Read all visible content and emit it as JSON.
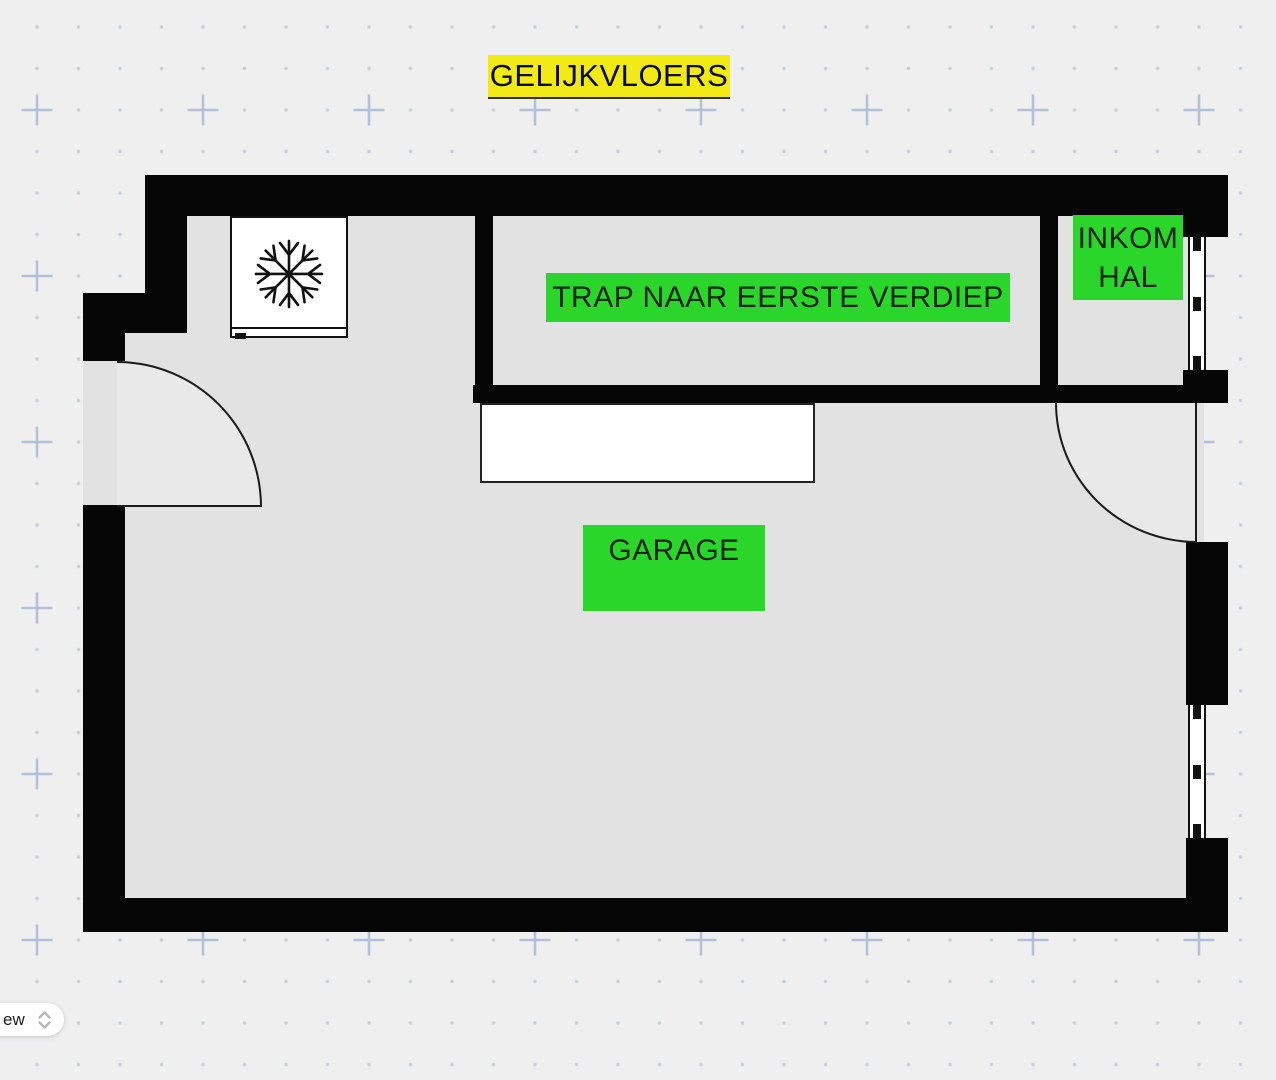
{
  "header": {
    "title": "GELIJKVLOERS"
  },
  "floor_plan": {
    "rooms": {
      "stairs": {
        "label": "TRAP NAAR EERSTE VERDIEP"
      },
      "entry_hall": {
        "line1": "INKOM",
        "line2": "HAL"
      },
      "garage": {
        "label": "GARAGE"
      }
    },
    "fixtures": {
      "freezer": "snowflake-icon",
      "workbench": "white-counter",
      "windows": 2,
      "doors": 2
    },
    "colors": {
      "room_label_bg": "#2bd62b",
      "title_highlight_bg": "#f2ea16",
      "wall": "#060606",
      "floor": "#e2e2e2",
      "door_swing": "#e9e9e9",
      "canvas_bg": "#efeff0",
      "grid_marks": "#b7c3d8"
    }
  },
  "controls": {
    "view_selector": {
      "visible_text": "ew",
      "icon": "chevron-up-down-icon"
    }
  }
}
